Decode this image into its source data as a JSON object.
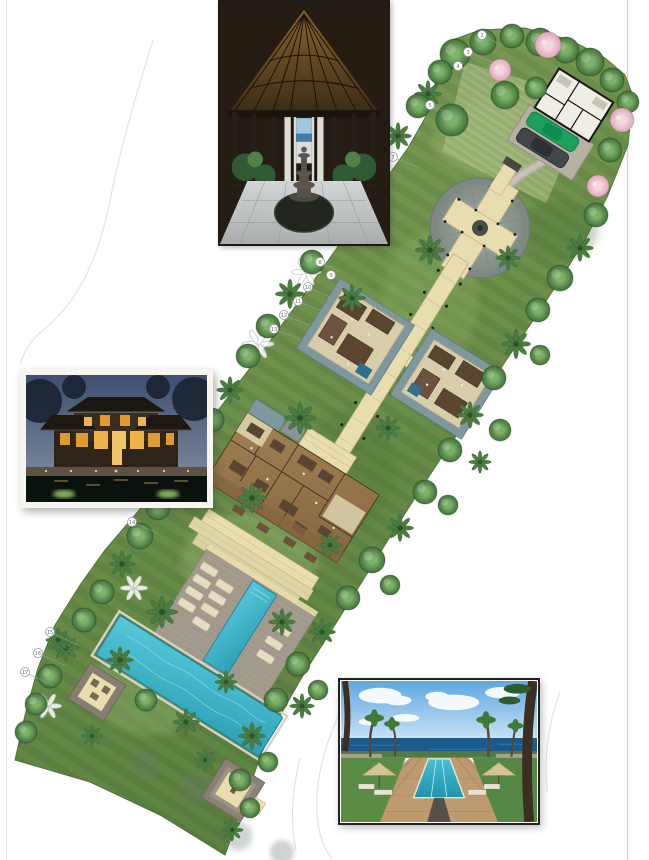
{
  "palette": {
    "grass": "#6f9350",
    "grassLight": "#8dab66",
    "grassDark": "#4c7239",
    "canopy": "#4e7d45",
    "palm": "#47773f",
    "pink": "#e9bcca",
    "path": "#e9dcae",
    "pathEdge": "#bfae7f",
    "plaza": "#929b95",
    "water": "#7f98a0",
    "poolWater": "#3fb3c6",
    "deck": "#a29b8e",
    "wood": "#97784f",
    "roof": "#5a4531",
    "stone": "#d8cdaa",
    "pavilion": "#867e71",
    "garage": "#f0ede5",
    "carGreen": "#1ba05e",
    "carDark": "#41464b",
    "scanLine": "#d2d5d8",
    "contour": "#e1e3e5",
    "calloutStroke": "#9aa0a5",
    "calloutText": "#6d7378"
  },
  "callouts": [
    {
      "label": "2",
      "x": 482,
      "y": 35,
      "lx": 502,
      "ly": 46
    },
    {
      "label": "3",
      "x": 468,
      "y": 52,
      "lx": 492,
      "ly": 62
    },
    {
      "label": "4",
      "x": 458,
      "y": 66,
      "lx": 486,
      "ly": 78
    },
    {
      "label": "5",
      "x": 430,
      "y": 105,
      "lx": 462,
      "ly": 118
    },
    {
      "label": "7",
      "x": 393,
      "y": 157,
      "lx": 420,
      "ly": 168
    },
    {
      "label": "8",
      "x": 320,
      "y": 262,
      "lx": 340,
      "ly": 272
    },
    {
      "label": "9",
      "x": 331,
      "y": 275,
      "lx": 350,
      "ly": 285
    },
    {
      "label": "10",
      "x": 308,
      "y": 287,
      "lx": 330,
      "ly": 297
    },
    {
      "label": "11",
      "x": 298,
      "y": 301,
      "lx": 322,
      "ly": 311
    },
    {
      "label": "12",
      "x": 284,
      "y": 315,
      "lx": 310,
      "ly": 325
    },
    {
      "label": "13",
      "x": 274,
      "y": 329,
      "lx": 300,
      "ly": 339
    },
    {
      "label": "14",
      "x": 132,
      "y": 522,
      "lx": 158,
      "ly": 533
    },
    {
      "label": "15",
      "x": 50,
      "y": 632,
      "lx": 78,
      "ly": 645
    },
    {
      "label": "16",
      "x": 38,
      "y": 653,
      "lx": 66,
      "ly": 666
    },
    {
      "label": "17",
      "x": 25,
      "y": 672,
      "lx": 54,
      "ly": 686
    }
  ]
}
